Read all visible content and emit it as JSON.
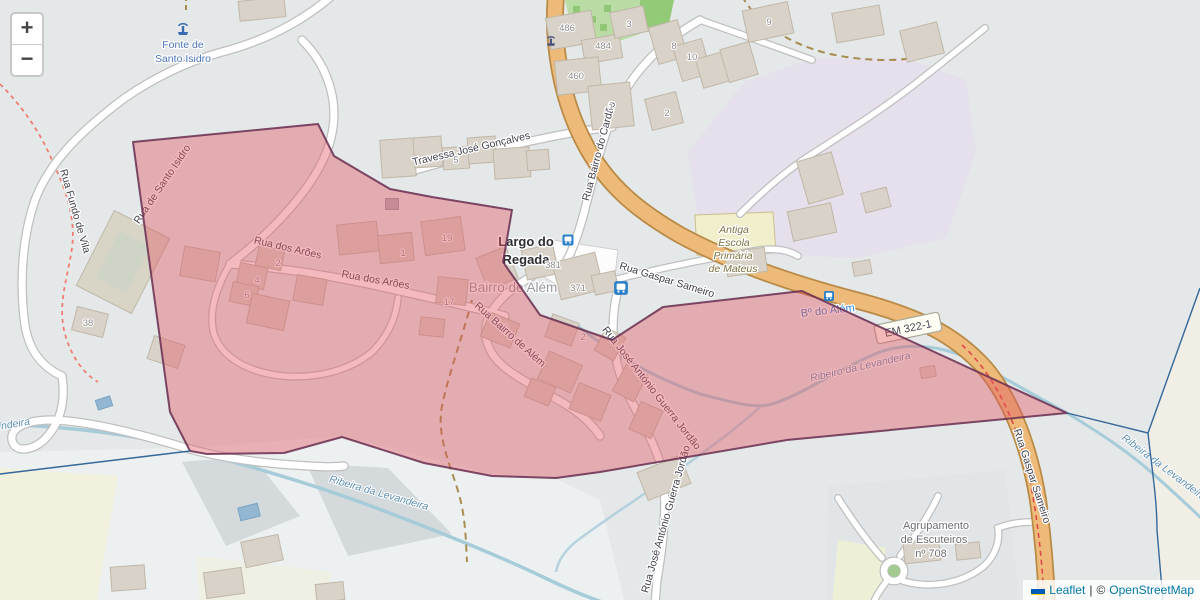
{
  "controls": {
    "zoom_in": "+",
    "zoom_out": "−"
  },
  "attribution": {
    "leaflet_label": "Leaflet",
    "separator": "|",
    "copyright_prefix": "©",
    "osm_label": "OpenStreetMap"
  },
  "road_badge": {
    "ref": "EM 322-1"
  },
  "streets": {
    "travessa": "Travessa José Gonçalves",
    "cardao": "Rua Bairro do Cardão",
    "santo_isidro": "Rua de Santo Isidro",
    "aroes": "Rua dos Arões",
    "aroes2": "Rua dos Arões",
    "bairro_alem": "Rua Bairro de Além",
    "guerra_jordao": "Rua José António Guerra Jordão",
    "guerra_jordao2": "Rua José António Guerra Jordão",
    "gaspar_sameiro": "Rua Gaspar Sameiro",
    "gaspar_sameiro2": "Rua Gaspar Sameiro",
    "fundo_vila": "Rua Fundo de Vila"
  },
  "places": {
    "fonte_line1": "Fonte de",
    "fonte_line2": "Santo Isidro",
    "largo_line1": "Largo do",
    "largo_line2": "Regada",
    "bairro_alem": "Bairro de Além",
    "escola_line1": "Antiga",
    "escola_line2": "Escola",
    "escola_line3": "Primária",
    "escola_line4": "de Mateus",
    "escuteiros_line1": "Agrupamento",
    "escuteiros_line2": "de Escuteiros",
    "escuteiros_line3": "nº 708",
    "b_alem": "Bº do Além"
  },
  "water": {
    "levandeira_sw": "Ribeira da Levandeira",
    "levandeira_mid": "Ribeiro da Levandeira",
    "levandeira_right": "Ribeira da Levandeira",
    "levandeira_left_fragment": "ndeira"
  },
  "housenumbers": [
    "486",
    "484",
    "460",
    "3",
    "8",
    "10",
    "9",
    "1",
    "2",
    "5",
    "19",
    "1",
    "2",
    "4",
    "6",
    "17",
    "2",
    "381",
    "371",
    "38"
  ],
  "colors": {
    "selection_fill": "#e35763",
    "selection_stroke": "#672d50",
    "boundary_line": "#34679a",
    "primary_road": "#edba7a",
    "water": "#a6cbd9"
  }
}
